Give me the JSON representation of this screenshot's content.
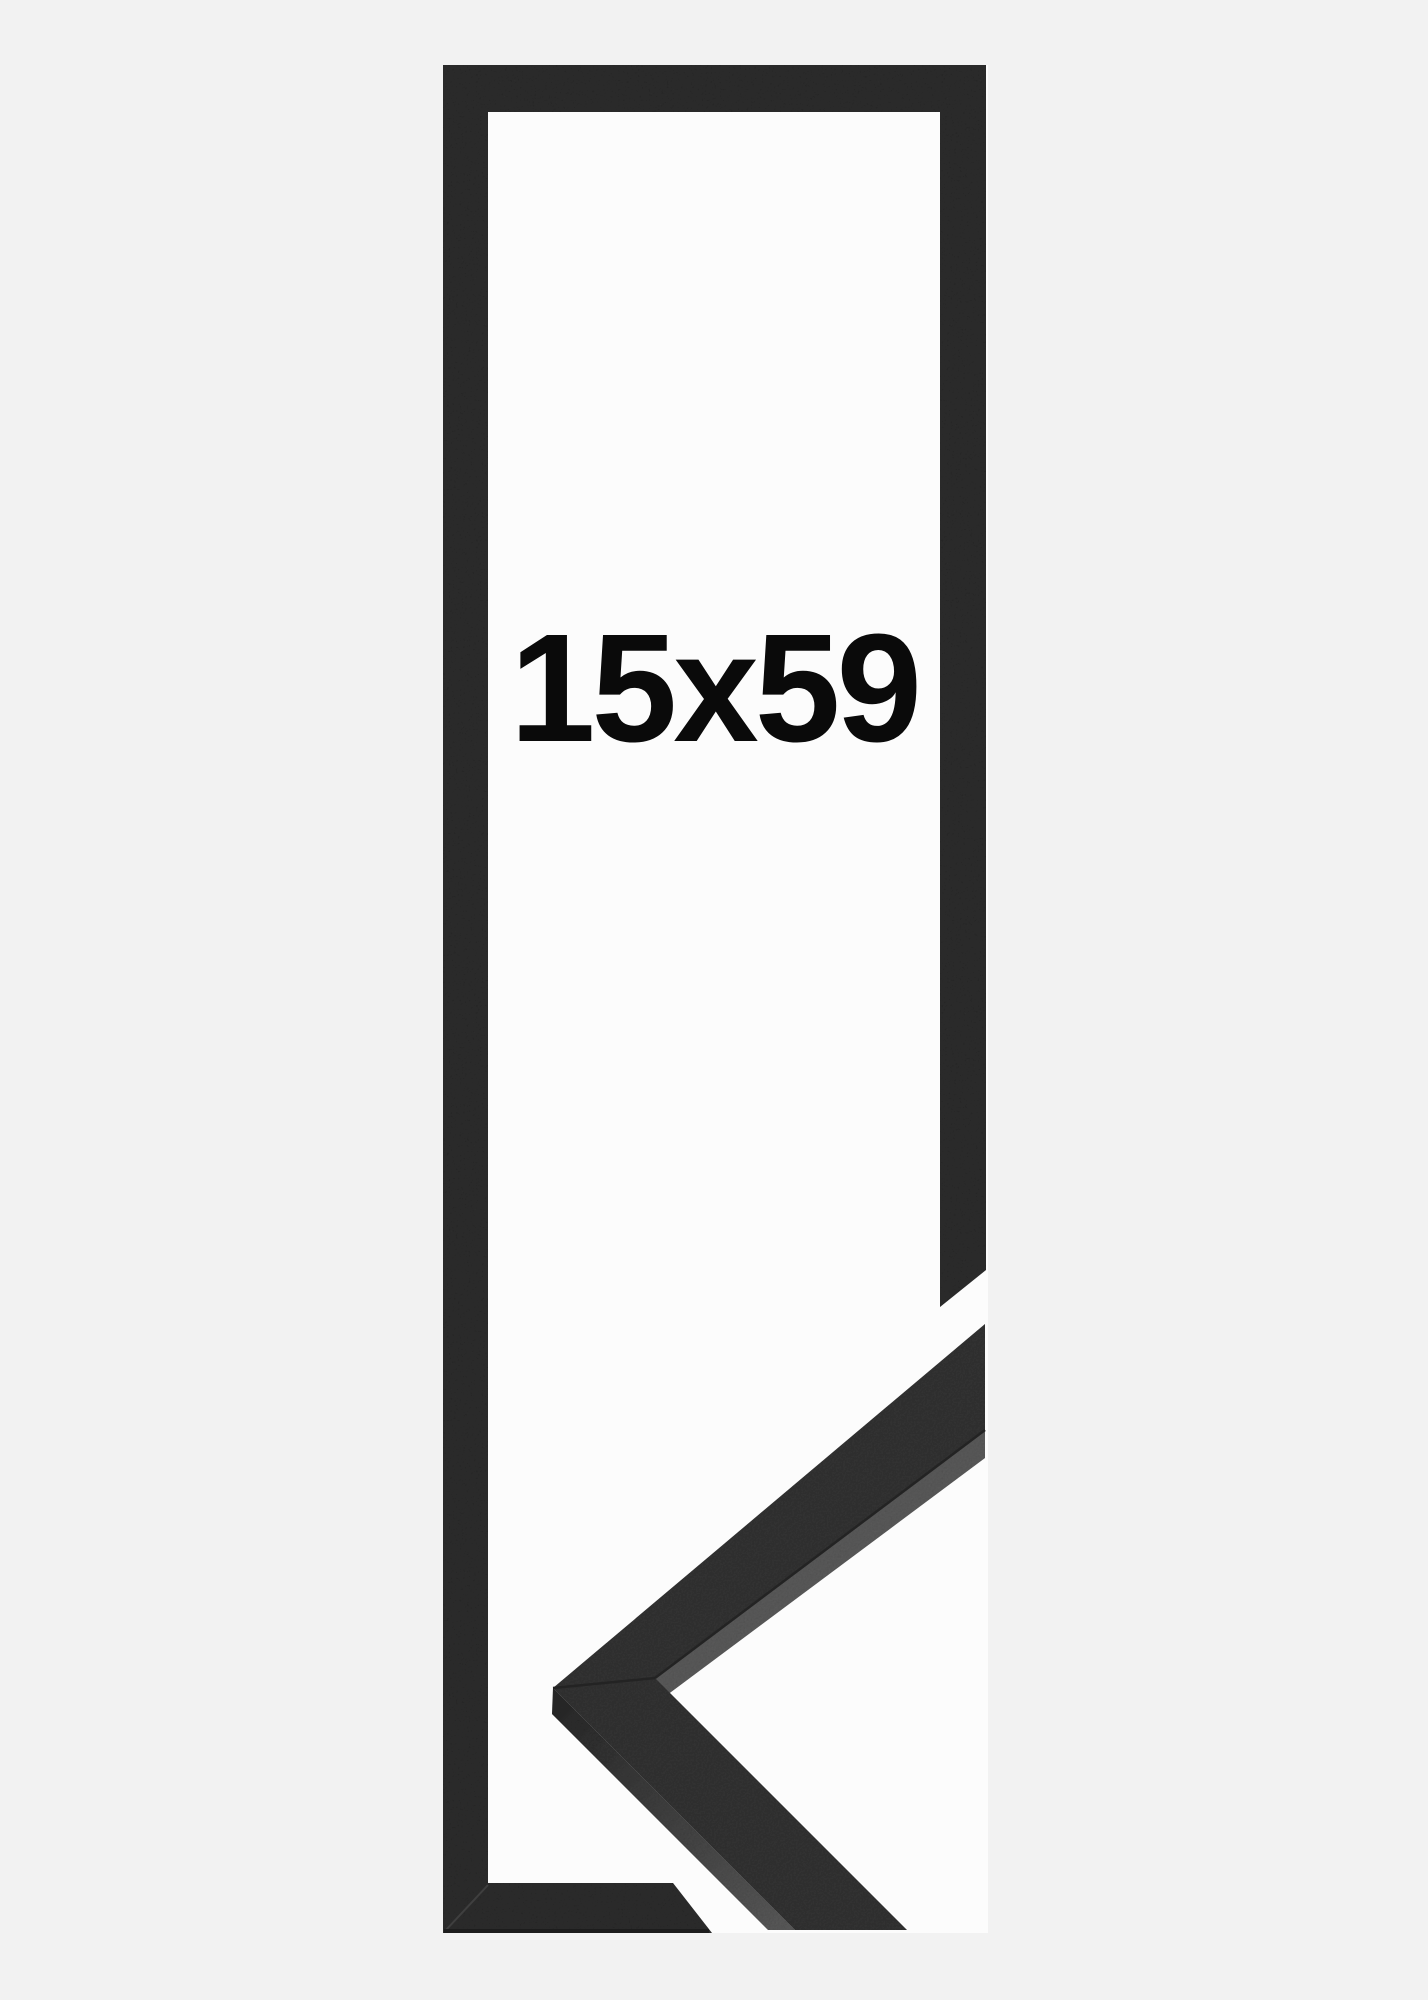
{
  "product_image": {
    "size_label": "15x59",
    "colors": {
      "page_background": "#f2f2f2",
      "photo_interior": "#fcfcfc",
      "frame": "#333333",
      "moulding_face": "#373737",
      "moulding_side_light": "#606060",
      "moulding_side_dark": "#2d2d2d",
      "seam": "#232323",
      "bottom_edge_shadow": "#1d1d1d",
      "label": "#0a0a0a"
    }
  }
}
